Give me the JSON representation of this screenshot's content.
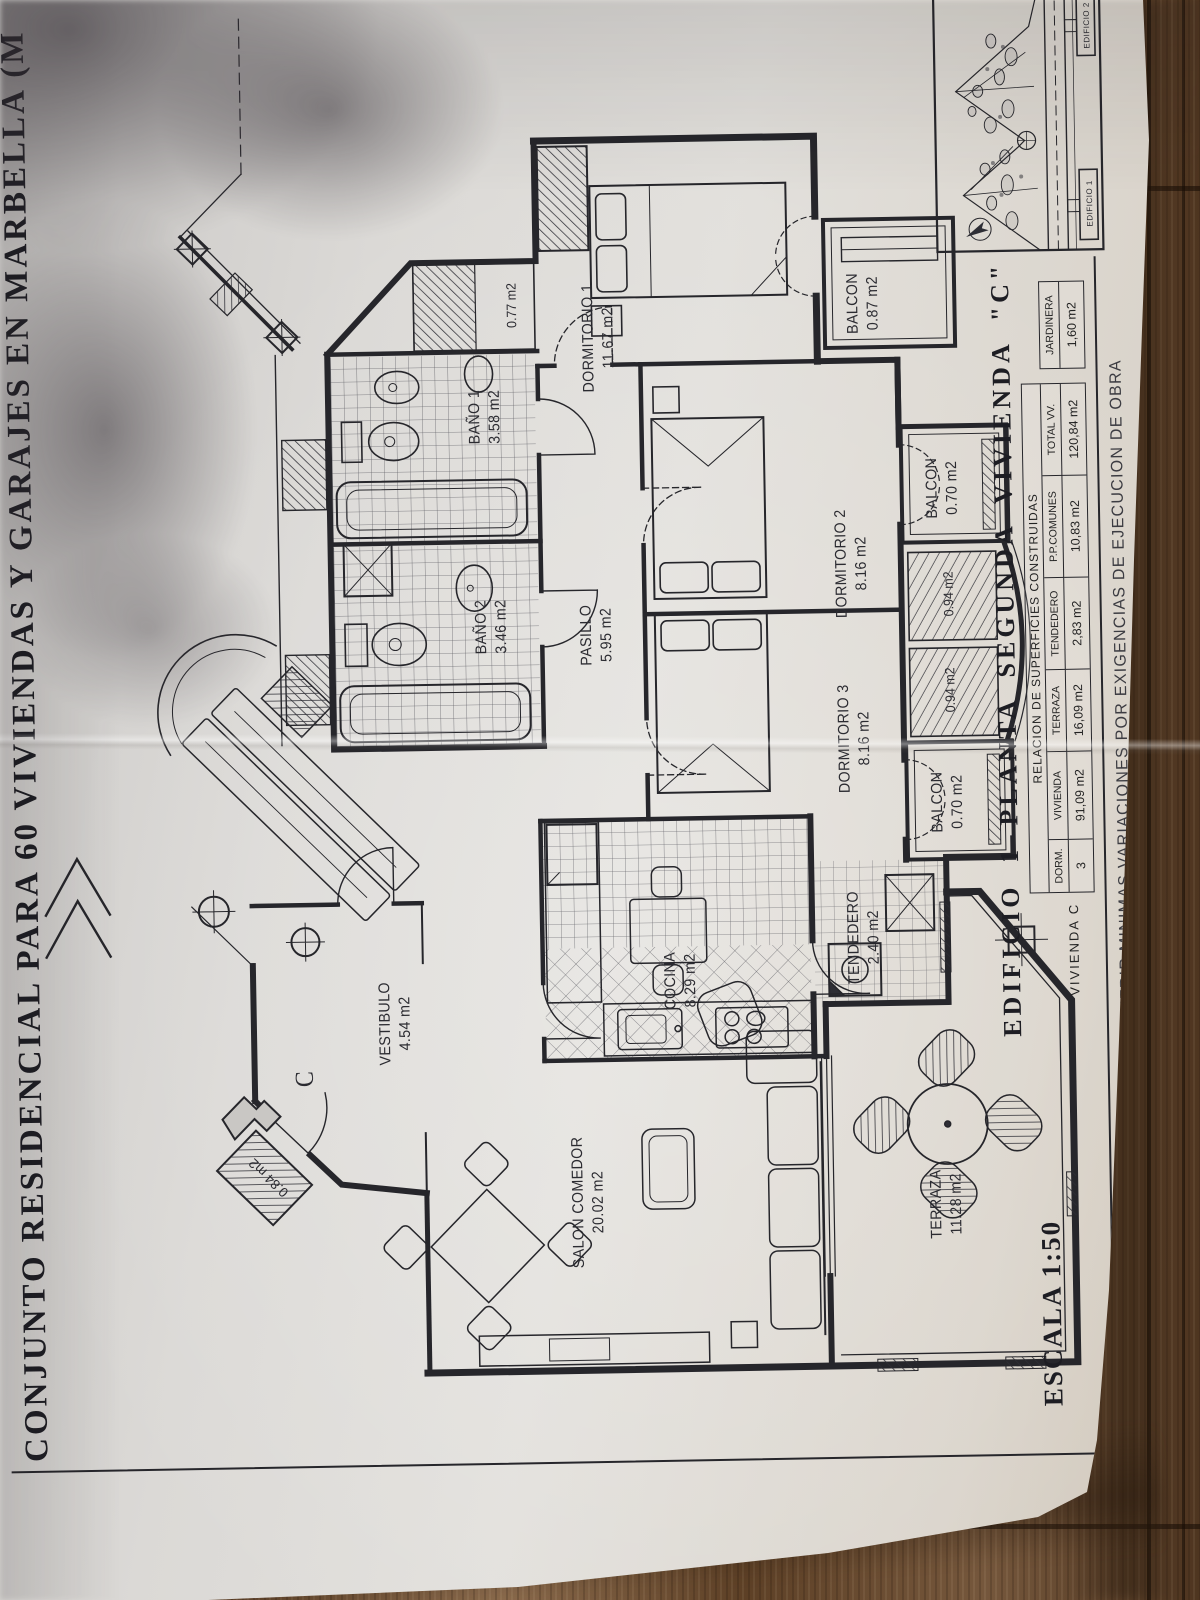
{
  "colors": {
    "ink": "#26262b",
    "paper": "#dedcd9",
    "wood": "#6b4e35"
  },
  "title": "CONJUNTO RESIDENCIAL PARA 60 VIVIENDAS Y GARAJES EN MARBELLA (M",
  "heading": "EDIFICIO 1 PLANTA SEGUNDA VIVIENDA \"C\"",
  "scale": "ESCALA 1:50",
  "note": "NOTA: LA DISTRIBUCION DE LAS VIVIENDAS PODRA SUFRIR MINIMAS VARIACIONES POR EXIGENCIAS DE EJECUCION DE OBRA",
  "table": {
    "title": "RELACION DE SUPERFICIES CONSTRUIDAS",
    "row_label": "VIVIENDA C",
    "columns": [
      "DORM.",
      "VIVIENDA",
      "TERRAZA",
      "TENDEDERO",
      "P.P.COMUNES",
      "TOTAL VV."
    ],
    "values": [
      "3",
      "91,09 m2",
      "16,09 m2",
      "2,83 m2",
      "10,83 m2",
      "120,84 m2"
    ],
    "side_column": "JARDINERA",
    "side_value": "1,60 m2"
  },
  "rooms": [
    {
      "name": "DORMITORIO 1",
      "area": "11.67 m2",
      "x": 1262,
      "y": 607
    },
    {
      "name": "DORMITORIO 2",
      "area": "8.16 m2",
      "x": 1032,
      "y": 856
    },
    {
      "name": "DORMITORIO 3",
      "area": "8.16 m2",
      "x": 857,
      "y": 856
    },
    {
      "name": "BAÑO 1",
      "area": "3.58 m2",
      "x": 1185,
      "y": 492
    },
    {
      "name": "BAÑO 2",
      "area": "3.46 m2",
      "x": 975,
      "y": 495
    },
    {
      "name": "PASILLO",
      "area": "5.95 m2",
      "x": 965,
      "y": 600
    },
    {
      "name": "COCINA",
      "area": "8.29 m2",
      "x": 618,
      "y": 678
    },
    {
      "name": "TENDEDERO",
      "area": "2.40 m2",
      "x": 658,
      "y": 862
    },
    {
      "name": "VESTIBULO",
      "area": "4.54 m2",
      "x": 580,
      "y": 392
    },
    {
      "name": "SALON COMEDOR",
      "area": "20.02 m2",
      "x": 398,
      "y": 582
    },
    {
      "name": "TERRAZA",
      "area": "11.28 m2",
      "x": 390,
      "y": 940
    },
    {
      "name": "BALCON",
      "area": "0.87 m2",
      "x": 1292,
      "y": 872
    },
    {
      "name": "BALCON",
      "area": "0.70 m2",
      "x": 1106,
      "y": 948
    },
    {
      "name": "BALCON",
      "area": "0.70 m2",
      "x": 792,
      "y": 948
    }
  ],
  "small_labels": [
    {
      "text": "0.77 m2",
      "x": 1296,
      "y": 520
    },
    {
      "text": "0.94 m2",
      "x": 904,
      "y": 952
    },
    {
      "text": "0.94 m2",
      "x": 1000,
      "y": 952
    },
    {
      "text": "0.84 m2",
      "x": 428,
      "y": 262,
      "rot": -45
    },
    {
      "text": "C",
      "x": 526,
      "y": 300,
      "cls": "entrance"
    }
  ],
  "inset": {
    "labels": [
      {
        "text": "EDIFICIO 1",
        "x": 1388,
        "y": 1100
      },
      {
        "text": "EDIFICIO 2",
        "x": 1566,
        "y": 1100
      }
    ]
  }
}
